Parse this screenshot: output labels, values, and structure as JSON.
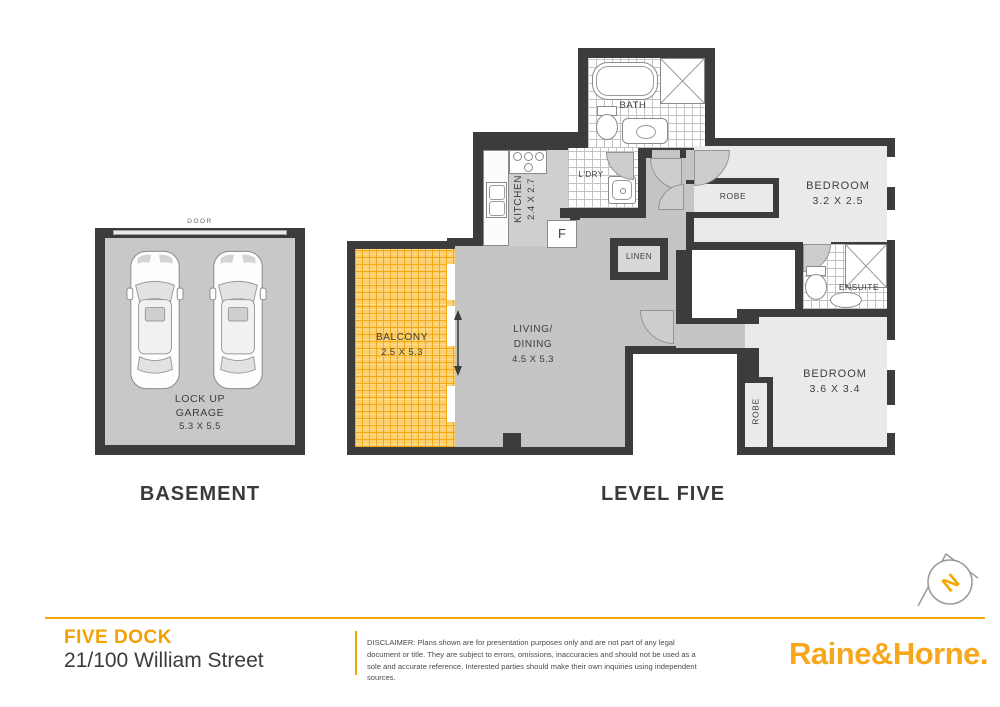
{
  "colors": {
    "wall": "#3c3c3c",
    "accent_orange": "#F2A104",
    "logo_orange": "#F7A71B",
    "balcony_tile": "#FCD06E",
    "floor_gray": "#C5C5C5",
    "floor_light": "#EAEAEA"
  },
  "basement": {
    "title": "BASEMENT",
    "door_label": "DOOR",
    "garage_label_line1": "LOCK UP",
    "garage_label_line2": "GARAGE",
    "garage_dims": "5.3 X 5.5"
  },
  "level_five": {
    "title": "LEVEL FIVE",
    "bath": {
      "label": "BATH"
    },
    "kitchen": {
      "label": "KITCHEN",
      "dims": "2.4 X 2.7"
    },
    "fridge_label": "F",
    "laundry": {
      "label": "L'DRY"
    },
    "robe1": {
      "label": "ROBE"
    },
    "bedroom1": {
      "label": "BEDROOM",
      "dims": "3.2 X 2.5"
    },
    "linen": {
      "label": "LINEN"
    },
    "ensuite": {
      "label": "ENSUITE"
    },
    "bedroom2": {
      "label": "BEDROOM",
      "dims": "3.6 X 3.4"
    },
    "robe2": {
      "label": "ROBE"
    },
    "living": {
      "label_line1": "LIVING/",
      "label_line2": "DINING",
      "dims": "4.5 X 5.3"
    },
    "balcony": {
      "label": "BALCONY",
      "dims": "2.5 X 5.3"
    }
  },
  "compass": {
    "label": "N"
  },
  "footer": {
    "suburb": "FIVE DOCK",
    "address": "21/100 William Street",
    "disclaimer": "DISCLAIMER: Plans shown are for presentation purposes only and are not part of any legal document or title. They are subject to errors, omissions, inaccuracies and should not be used as a sole and accurate reference. Interested parties should make their own inquiries using independent sources.",
    "brand": "Raine&Horne."
  }
}
